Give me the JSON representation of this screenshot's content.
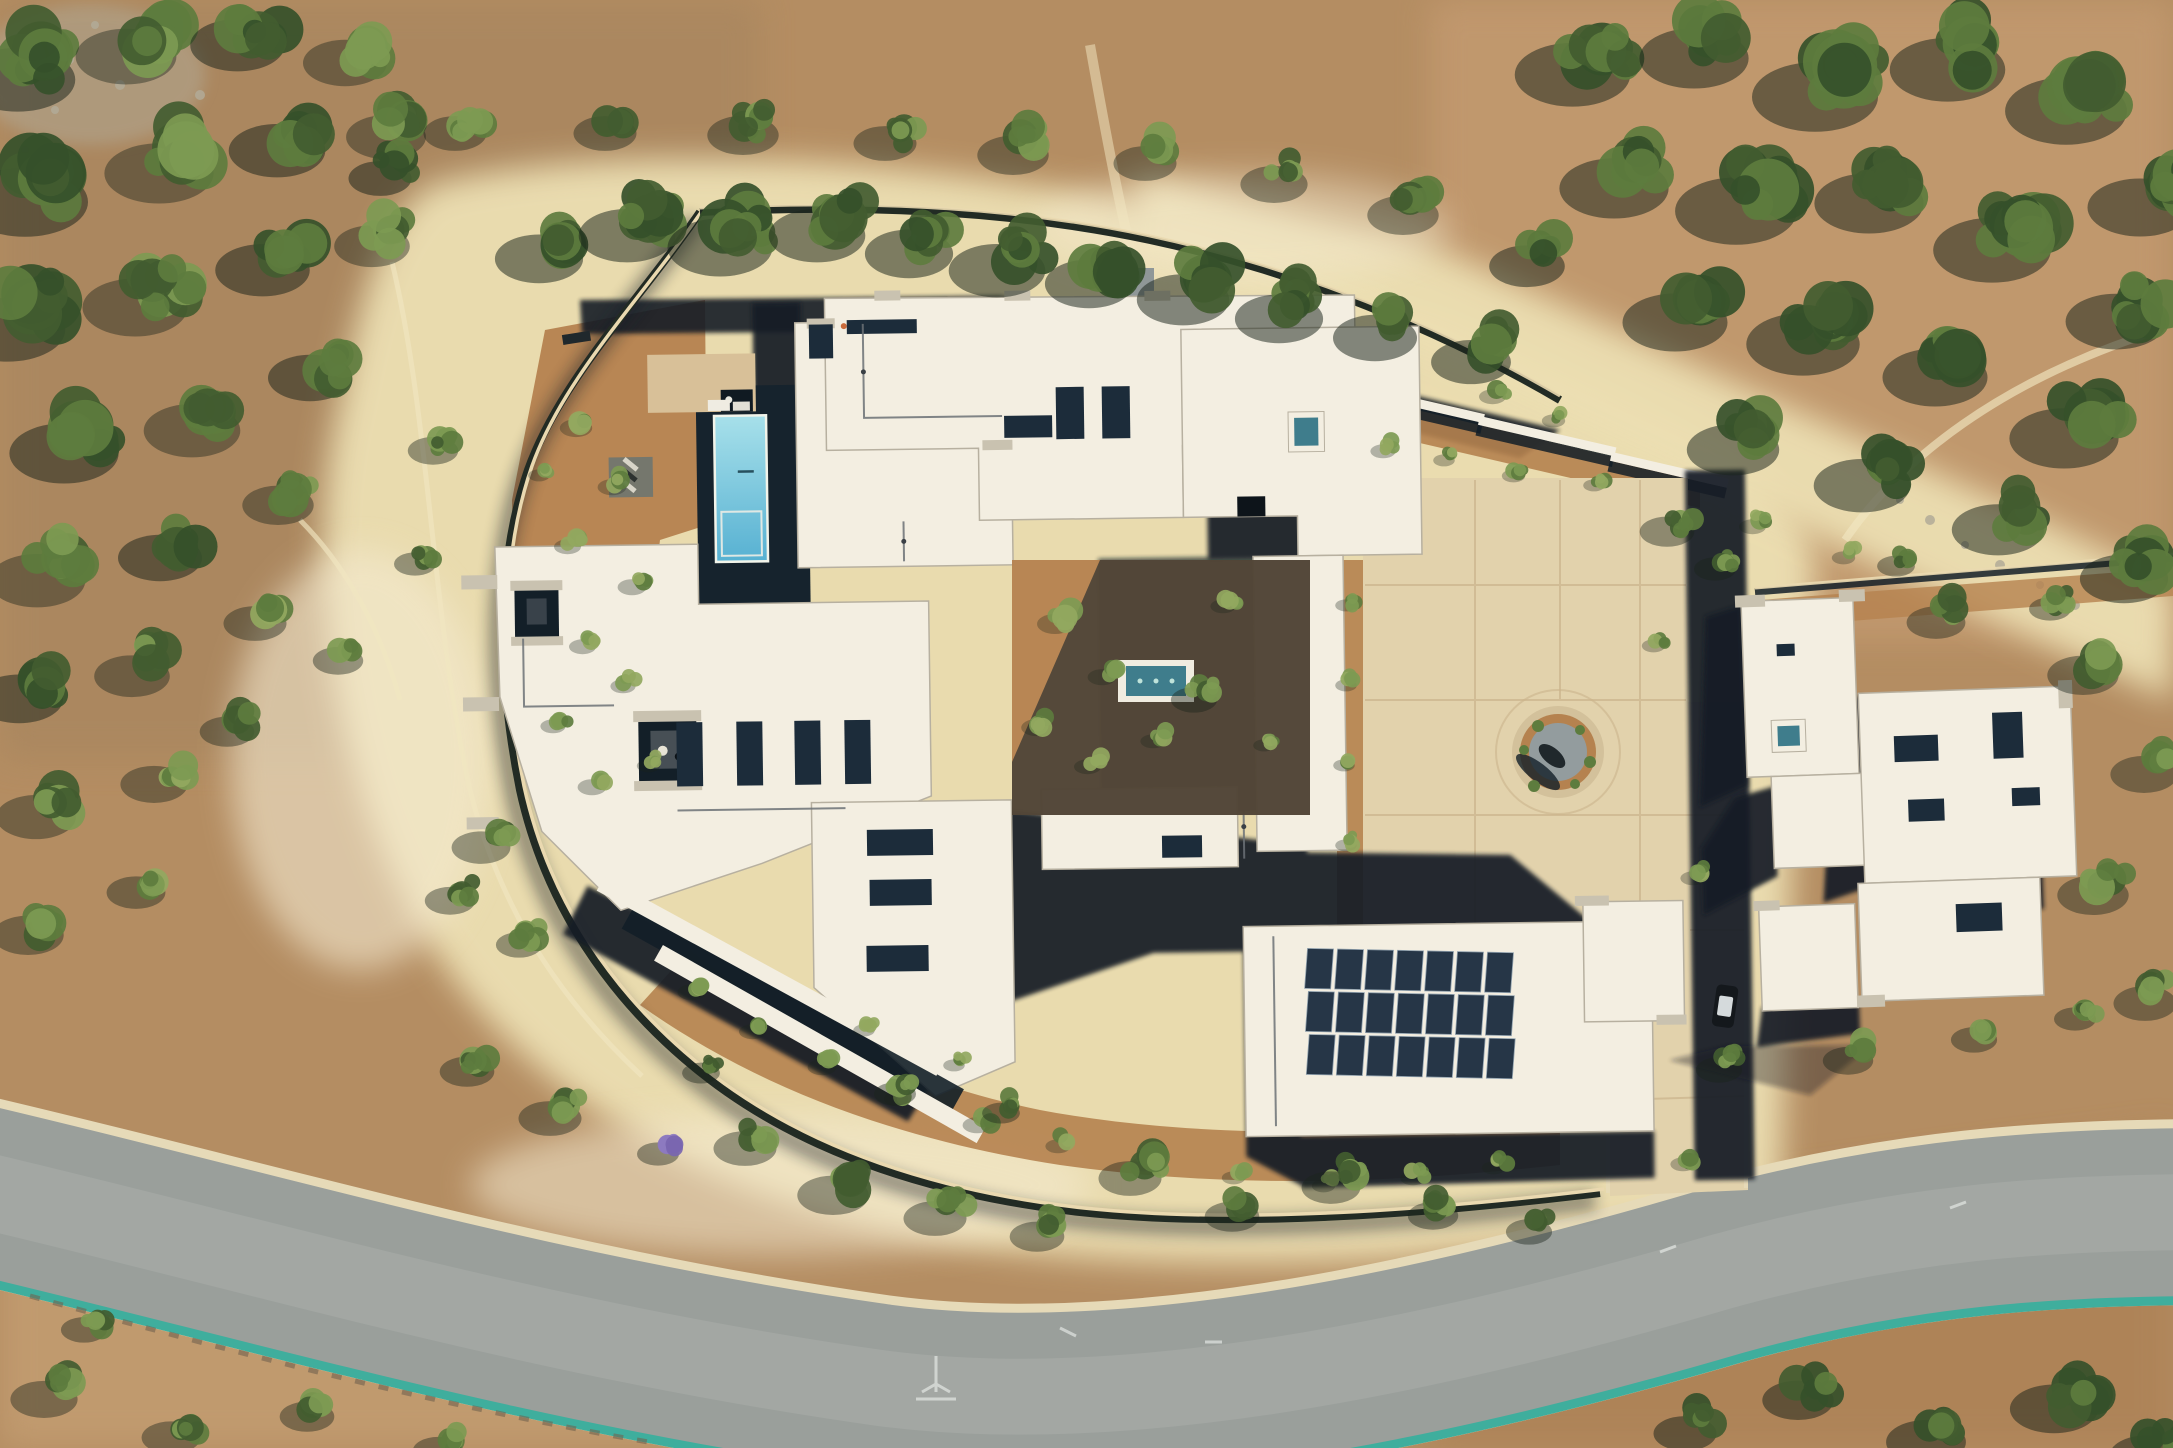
{
  "meta": {
    "scene_title": "Aerial drone photograph of a Santa Fe pueblo-style desert estate",
    "labels": {
      "terrain": "High-desert terrain with pinon-juniper scrub",
      "road": "Curved paved access road with concrete curbs",
      "road_markings": "Faint utility chalk markings on asphalt",
      "perimeter_wall": "Curved perimeter garden wall",
      "main_house": "Main residence with flat white pueblo roofs and skylights",
      "pool": "Rectangular swimming pool",
      "pool_deck": "Dark stone pool terrace",
      "pool_patio": "Concrete pool patio",
      "spa": "Spa / equipment vault",
      "lounge_pad": "Gravel pad with chaise lounges",
      "courtyard": "Central courtyard garden",
      "water_feature": "Tiled courtyard water feature",
      "solar": "Rooftop solar panel array",
      "motor_court": "Concrete motor court",
      "planter": "Circular landscaped planter with boulder",
      "driveway": "Driveway connecting motor court to road",
      "garage": "Garage wing",
      "guest_house": "Guest house casita",
      "car": "Parked car",
      "north_path": "Sand path and gate above north wall",
      "ne_walls": "Stepped retaining walls",
      "vegetation": "Juniper and pinon shrubs"
    }
  },
  "palette": {
    "dirt_base": "#b48d62",
    "dirt_nw": "#a8865e",
    "dirt_ne": "#c39a70",
    "dirt_se": "#ad8257",
    "dirt_sw": "#c49e72",
    "sand": "#ecdfb2",
    "sand_bright": "#f4ead0",
    "trail": "#f1e6c2",
    "bed": "#b5824f",
    "court": "#e2d2ac",
    "court_joint": "#cbb48c",
    "patio": "#d8c098",
    "gravel": "#939c9e",
    "stone": "#b2ab98",
    "roof": "#f3eee1",
    "roof_bright": "#faf6ec",
    "cap": "#c9c2b0",
    "parapet": "#b7b0a0",
    "shade": "#131f28",
    "glass": "#1c2c3a",
    "glass_teal": "#3f7d8c",
    "pool_top": "#a7e0ea",
    "pool_bot": "#57b1d2",
    "deck": "#16232d",
    "panel": "#263647",
    "panel_edge": "#8fa0ad",
    "road": "#9a9f9b",
    "road_light": "#abb0ac",
    "curb": "#e6dab8",
    "curb_teal": "#3fae9d",
    "green_l": "#7d9a53",
    "green_m": "#5d7c3e",
    "green_d": "#425c30",
    "green_y": "#93a860",
    "purple": "#8d79c0",
    "veg_shadow": "#1a241a",
    "conduit": "#6b7176"
  },
  "road": {
    "path": "M -40 1185 C 260 1255, 540 1340, 880 1388 C 1120 1420, 1420 1360, 1720 1272 C 1900 1222, 2050 1212, 2215 1212",
    "width": 168,
    "curb_extra": 18,
    "teal_extra": 8,
    "teal_dy": 5
  },
  "solar": {
    "cols": 7,
    "rows": 3,
    "x": 1352,
    "y": 958,
    "panel_w": 26,
    "panel_h": 40,
    "col_gap": 4,
    "row_gap": 3,
    "row_shift": 4,
    "tilt": 3
  },
  "vegetation": {
    "clusters": [
      [
        45,
        55,
        55,
        1
      ],
      [
        150,
        35,
        48,
        0
      ],
      [
        260,
        25,
        45,
        1
      ],
      [
        365,
        45,
        40,
        0
      ],
      [
        55,
        175,
        60,
        1
      ],
      [
        185,
        150,
        52,
        0
      ],
      [
        300,
        130,
        46,
        1
      ],
      [
        405,
        120,
        38,
        0
      ],
      [
        35,
        305,
        55,
        1
      ],
      [
        160,
        285,
        50,
        0
      ],
      [
        285,
        250,
        45,
        1
      ],
      [
        390,
        230,
        36,
        0
      ],
      [
        90,
        430,
        52,
        1
      ],
      [
        215,
        410,
        46,
        0
      ],
      [
        330,
        360,
        40,
        1
      ],
      [
        60,
        560,
        46,
        0
      ],
      [
        180,
        540,
        40,
        1
      ],
      [
        295,
        490,
        34,
        0
      ],
      [
        40,
        680,
        42,
        1
      ],
      [
        150,
        660,
        36,
        0
      ],
      [
        270,
        610,
        30,
        2
      ],
      [
        55,
        800,
        38,
        0
      ],
      [
        170,
        770,
        32,
        2
      ],
      [
        45,
        920,
        34,
        0
      ],
      [
        150,
        880,
        28,
        2
      ],
      [
        240,
        720,
        26,
        0
      ],
      [
        350,
        650,
        24,
        2
      ],
      [
        425,
        555,
        20,
        0
      ],
      [
        445,
        440,
        24,
        0
      ],
      [
        470,
        120,
        30,
        0
      ],
      [
        395,
        165,
        30,
        1
      ],
      [
        560,
        240,
        42,
        1
      ],
      [
        650,
        215,
        46,
        1
      ],
      [
        745,
        225,
        50,
        1
      ],
      [
        840,
        215,
        46,
        1
      ],
      [
        930,
        235,
        42,
        1
      ],
      [
        1020,
        250,
        46,
        1
      ],
      [
        1110,
        265,
        42,
        1
      ],
      [
        1205,
        280,
        44,
        1
      ],
      [
        1300,
        300,
        42,
        1
      ],
      [
        1395,
        320,
        40,
        1
      ],
      [
        1490,
        345,
        38,
        1
      ],
      [
        620,
        120,
        30,
        0
      ],
      [
        760,
        120,
        34,
        0
      ],
      [
        900,
        130,
        30,
        0
      ],
      [
        1030,
        140,
        34,
        0
      ],
      [
        1160,
        150,
        30,
        0
      ],
      [
        1290,
        170,
        32,
        0
      ],
      [
        1420,
        200,
        34,
        0
      ],
      [
        1545,
        250,
        36,
        1
      ],
      [
        1600,
        50,
        55,
        1
      ],
      [
        1720,
        35,
        52,
        1
      ],
      [
        1845,
        70,
        60,
        1
      ],
      [
        1975,
        45,
        55,
        1
      ],
      [
        2095,
        85,
        58,
        1
      ],
      [
        2165,
        185,
        50,
        1
      ],
      [
        1640,
        165,
        52,
        1
      ],
      [
        1765,
        185,
        58,
        1
      ],
      [
        1895,
        180,
        52,
        1
      ],
      [
        2020,
        225,
        56,
        1
      ],
      [
        2140,
        300,
        48,
        1
      ],
      [
        1700,
        300,
        50,
        1
      ],
      [
        1830,
        320,
        54,
        1
      ],
      [
        1960,
        355,
        50,
        1
      ],
      [
        2090,
        415,
        52,
        1
      ],
      [
        1755,
        430,
        44,
        1
      ],
      [
        1885,
        465,
        46,
        1
      ],
      [
        2020,
        510,
        44,
        1
      ],
      [
        2145,
        560,
        42,
        1
      ],
      [
        1680,
        520,
        26,
        0
      ],
      [
        1950,
        610,
        28,
        0
      ],
      [
        2100,
        660,
        34,
        0
      ],
      [
        2160,
        760,
        32,
        0
      ],
      [
        2110,
        880,
        34,
        0
      ],
      [
        2160,
        990,
        30,
        0
      ],
      [
        585,
        420,
        18,
        4
      ],
      [
        620,
        480,
        16,
        4
      ],
      [
        575,
        540,
        15,
        4
      ],
      [
        640,
        580,
        16,
        4
      ],
      [
        590,
        640,
        15,
        4
      ],
      [
        630,
        680,
        14,
        4
      ],
      [
        560,
        720,
        14,
        4
      ],
      [
        600,
        780,
        16,
        4
      ],
      [
        655,
        760,
        13,
        4
      ],
      [
        545,
        470,
        12,
        4
      ],
      [
        495,
        835,
        28,
        0
      ],
      [
        462,
        890,
        24,
        0
      ],
      [
        530,
        935,
        22,
        0
      ],
      [
        1065,
        615,
        20,
        4
      ],
      [
        1110,
        670,
        16,
        4
      ],
      [
        1045,
        720,
        17,
        4
      ],
      [
        1095,
        760,
        15,
        4
      ],
      [
        1160,
        735,
        14,
        4
      ],
      [
        1230,
        600,
        14,
        4
      ],
      [
        1205,
        690,
        22,
        0
      ],
      [
        1270,
        740,
        12,
        4
      ],
      [
        1390,
        445,
        14,
        4
      ],
      [
        1450,
        455,
        12,
        4
      ],
      [
        1520,
        470,
        13,
        4
      ],
      [
        1600,
        480,
        12,
        4
      ],
      [
        1352,
        600,
        12,
        4
      ],
      [
        1352,
        680,
        12,
        4
      ],
      [
        1350,
        760,
        12,
        4
      ],
      [
        1352,
        840,
        12,
        4
      ],
      [
        1660,
        640,
        13,
        4
      ],
      [
        1500,
        390,
        15,
        4
      ],
      [
        1560,
        415,
        13,
        4
      ],
      [
        1760,
        520,
        15,
        4
      ],
      [
        1850,
        552,
        13,
        4
      ],
      [
        700,
        985,
        16,
        4
      ],
      [
        760,
        1025,
        15,
        4
      ],
      [
        830,
        1060,
        16,
        4
      ],
      [
        905,
        1092,
        15,
        4
      ],
      [
        985,
        1118,
        16,
        4
      ],
      [
        1065,
        1140,
        14,
        4
      ],
      [
        1150,
        1158,
        14,
        4
      ],
      [
        1240,
        1172,
        13,
        4
      ],
      [
        1330,
        1180,
        13,
        4
      ],
      [
        1420,
        1172,
        14,
        4
      ],
      [
        1500,
        1162,
        13,
        4
      ],
      [
        870,
        1025,
        12,
        4
      ],
      [
        960,
        1060,
        12,
        4
      ],
      [
        1690,
        1158,
        14,
        4
      ],
      [
        480,
        1060,
        26,
        0
      ],
      [
        565,
        1105,
        30,
        0
      ],
      [
        668,
        1145,
        20,
        3
      ],
      [
        760,
        1135,
        30,
        0
      ],
      [
        850,
        1180,
        34,
        0
      ],
      [
        950,
        1205,
        30,
        0
      ],
      [
        1050,
        1225,
        26,
        0
      ],
      [
        1145,
        1165,
        30,
        0
      ],
      [
        1245,
        1205,
        26,
        0
      ],
      [
        1345,
        1175,
        28,
        0
      ],
      [
        1445,
        1205,
        24,
        0
      ],
      [
        1540,
        1222,
        22,
        0
      ],
      [
        905,
        1085,
        20,
        0
      ],
      [
        1010,
        1105,
        18,
        0
      ],
      [
        710,
        1065,
        18,
        0
      ],
      [
        60,
        1385,
        32,
        0
      ],
      [
        185,
        1425,
        28,
        0
      ],
      [
        320,
        1405,
        26,
        0
      ],
      [
        95,
        1320,
        22,
        0
      ],
      [
        450,
        1440,
        24,
        0
      ],
      [
        1700,
        1420,
        30,
        1
      ],
      [
        1815,
        1385,
        34,
        1
      ],
      [
        1945,
        1425,
        38,
        1
      ],
      [
        2075,
        1390,
        42,
        1
      ],
      [
        2165,
        1440,
        36,
        1
      ],
      [
        1725,
        560,
        20,
        0
      ],
      [
        1905,
        558,
        18,
        0
      ],
      [
        2060,
        600,
        20,
        0
      ],
      [
        1700,
        872,
        14,
        4
      ],
      [
        1730,
        1060,
        22,
        0
      ],
      [
        1860,
        1050,
        24,
        0
      ],
      [
        1985,
        1030,
        22,
        0
      ],
      [
        2085,
        1010,
        20,
        0
      ]
    ]
  }
}
